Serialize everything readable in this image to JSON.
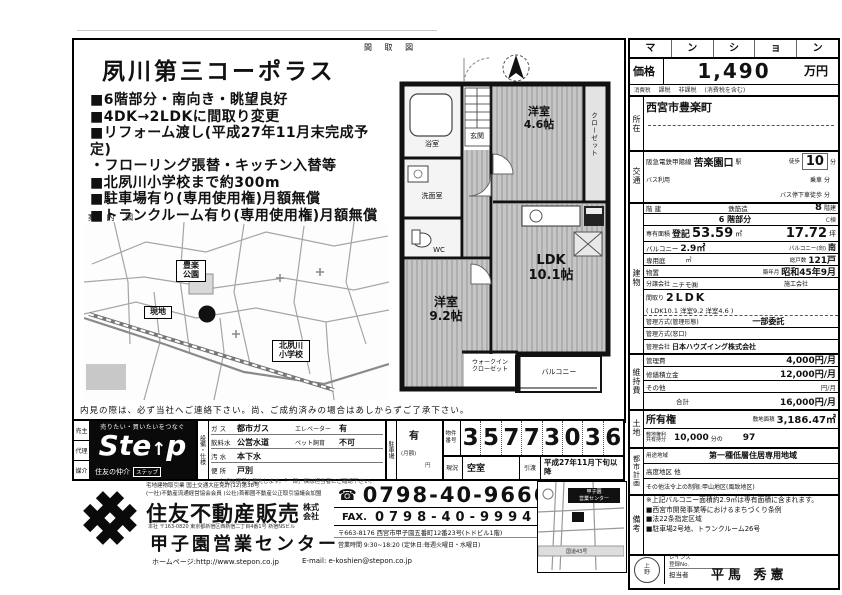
{
  "flyer": {
    "plan_figure_label": "間 取 図",
    "title": "夙川第三コーポラス",
    "bullets": [
      "■6階部分・南向き・眺望良好",
      "■4DK→2LDKに間取り変更",
      "■リフォーム渡し(平成27年11月末完成予定)",
      "・フローリング張替・キッチン入替等",
      "■北夙川小学校まで約300m",
      "■駐車場有り(専用使用権)月額無償",
      "■トランクルーム有り(専用使用権)月額無償"
    ],
    "map_label": "案 内 図",
    "map": {
      "park": "豊楽\n公園",
      "site": "現地",
      "school": "北夙川\n小学校"
    },
    "plan": {
      "entrance": "玄関",
      "bath": "浴室",
      "washroom": "洗面室",
      "wc": "WC",
      "room1": "洋室",
      "room1_size": "4.6帖",
      "closet": "クローゼット",
      "room2": "洋室",
      "room2_size": "9.2帖",
      "ldk": "LDK",
      "ldk_size": "10.1帖",
      "wic": "ウォークイン\nクローゼット",
      "balcony": "バルコニー"
    },
    "notice": "内見の際は、必ず当社へご連絡下さい。尚、ご成約済みの場合はあしからずご了承下さい。"
  },
  "panel": {
    "type_letters": [
      "マ",
      "ン",
      "シ",
      "ョ",
      "ン"
    ],
    "price_label": "価格",
    "price_value": "1,490",
    "price_unit": "万円",
    "tax_label": "消費税",
    "tax_notes": [
      "課税",
      "非課税",
      "(消費税を含む)"
    ],
    "addr_label": "所在",
    "addr_value": "西宮市豊楽町",
    "access_label": "交通",
    "access": {
      "line": "阪急電鉄甲陽線",
      "station": "苦楽園口",
      "station_suffix": "駅",
      "walk": "徒歩",
      "walk_min": "10",
      "min": "分",
      "bus_use": "バス利用",
      "ride": "乗車",
      "bus_alight": "バス停下車徒歩"
    },
    "bldg_label": "建物",
    "bldg": {
      "floors_label": "階 建",
      "structure": "鉄筋造",
      "floors": "8",
      "floors_unit": "階建",
      "floor_at": "6 階部分",
      "wing": "C棟",
      "area_label": "専有面積",
      "area_reg": "登記",
      "area": "53.59",
      "area_unit": "㎡",
      "area_tsubo": "17.72",
      "tsubo_unit": "坪",
      "balcony_label": "バルコニー",
      "balcony_area": "2.9㎡",
      "balcony_dir_label": "バルコニー(向)",
      "balcony_dir": "南",
      "garden_label": "専用庭",
      "garden_unit": "㎡",
      "units_label": "総戸数",
      "units": "121戸",
      "storage_label": "物置",
      "built_label": "築年月",
      "built": "昭和45年9月",
      "seller_label": "分譲会社",
      "seller": "ニチモ㈱",
      "builder_label": "施工会社",
      "layout_label": "間取り",
      "layout": "2LDK",
      "layout_detail": "( LDK10.1 洋室9.2 洋室4.6 )",
      "mgmt_style_label": "管理方式(管理形態)",
      "mgmt_style": "一部委託",
      "mgmt_window_label": "管理方式(窓口)",
      "mgmt_co_label": "管理会社",
      "mgmt_co": "日本ハウズイング株式会社"
    },
    "fees_label": "維持費",
    "fees": {
      "mgmt_label": "管理費",
      "mgmt": "4,000円/月",
      "repair_label": "修繕積立金",
      "repair": "12,000円/月",
      "other_label": "その他",
      "other": "円/月",
      "total_label": "合計",
      "total": "16,000円/月"
    },
    "land_label": "土地",
    "land": {
      "right": "所有権",
      "site_area_label": "敷地面積",
      "site_area": "3,186.47㎡",
      "share_label": "敷地権利\n共有持分",
      "share_a": "10,000",
      "share_mid": "分の",
      "share_b": "97"
    },
    "city_label": "都市計画",
    "city": {
      "zone_label": "用途地域",
      "zone": "第一種低層住居専用地域",
      "height_label": "高度地区 他",
      "other": "その他法令上の制限:甲山地区(風致地区)"
    },
    "notes_label": "備考",
    "notes": [
      "※上記バルコニー面積約2.9㎡は専有面積に含まれます。",
      "■西宮市開発事業等におけるまちづくり条例",
      "■法22条指定区域",
      "■駐車場2号地、トランクルーム26号"
    ],
    "reins_label": "レインズ\n登録No.",
    "agent_label": "担当者",
    "agent_name": "平馬 秀憲",
    "stamp": "上\n野"
  },
  "bottom": {
    "dealtype": [
      "売主",
      "代理",
      "媒介"
    ],
    "step": {
      "tagline": "売りたい・買いたいをつなぐ",
      "logo_left": "Ste",
      "logo_arrow": "↑",
      "logo_right": "p",
      "brand": "住友の仲介",
      "badge": "ステップ"
    },
    "equip_header": "設備・仕様",
    "equip_rows": [
      {
        "l": "ガ ス",
        "v": "都市ガス"
      },
      {
        "l": "飲料水",
        "v": "公営水道"
      },
      {
        "l": "汚 水",
        "v": "本下水"
      },
      {
        "l": "便 所",
        "v": "戸別"
      }
    ],
    "equip_right": [
      {
        "l": "エレベーター",
        "v": "有"
      },
      {
        "l": "ペット飼育",
        "v": "不可"
      }
    ],
    "equip_note": "上記は現況を優先します。「一部」欄は担当者にご確認下さい。",
    "parking_label": "駐車場",
    "parking_value": "有",
    "parking_note1": "(月額)",
    "parking_note2": "円",
    "no_label": "物件\n番号",
    "no_digits": [
      "3",
      "5",
      "7",
      "7",
      "3",
      "0",
      "3",
      "6"
    ],
    "status_label": "現況",
    "status": "空室",
    "handover_label": "引渡",
    "handover": "平成27年11月下旬以降",
    "company": {
      "license1": "宅地建物取引業 国土交通大臣免許(12)第38号",
      "license2": "(一社)不動産流通経営協会会員 (公社)首都圏不動産公正取引協議会加盟",
      "name": "住友不動産販売",
      "suffix": "株式\n会社",
      "hq": "本社 〒163-0820 東京都新宿区西新宿二丁目4番1号 新宿NSビル",
      "office": "甲子園営業センター",
      "url_label": "ホームページ:",
      "url": "http://www.stepon.co.jp",
      "email_label": "E-mail:",
      "email": "e-koshien@stepon.co.jp"
    },
    "contact": {
      "phone_icon": "☎",
      "phone": "0798-40-9666",
      "fax_label": "FAX.",
      "fax": "0798-40-9994",
      "address": "〒663-8176 西宮市甲子園五番町12番23号(トドビル1階)",
      "hours": "営業時間 9:30~18:20 (定休日:毎週火曜日・水曜日)"
    },
    "office_map": {
      "label": "甲子園\n営業センター",
      "road": "国道43号"
    }
  }
}
